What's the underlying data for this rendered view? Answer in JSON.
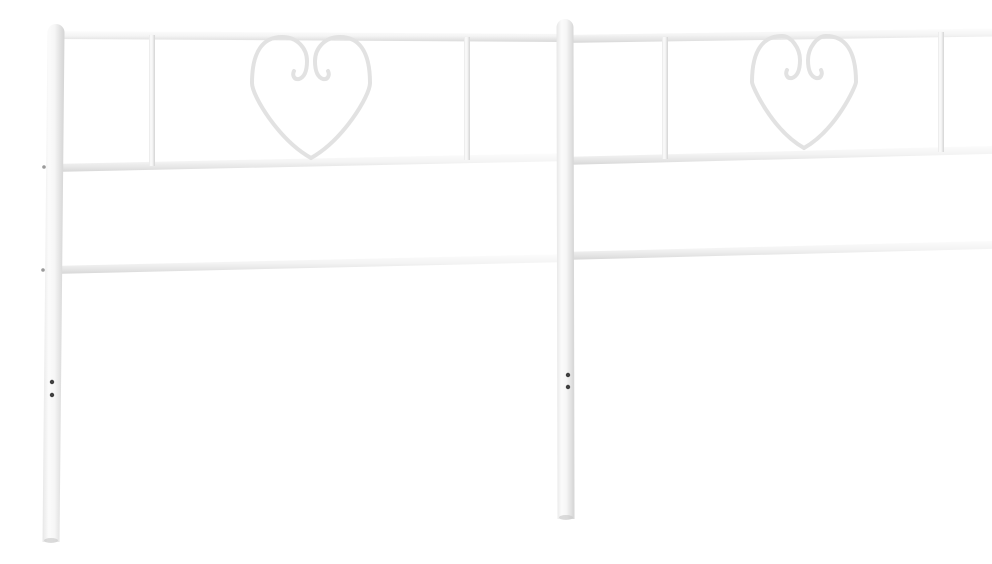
{
  "scene": {
    "description": "Product photo of a white metal headboard with two heart-shaped scrollwork panels, vertical balusters and three horizontal rails, on a plain white background",
    "background_color": "#ffffff",
    "colors": {
      "metal_highlight": "#fdfdfd",
      "metal_base": "#f4f4f4",
      "metal_shade": "#d6d6d6",
      "heart_stroke": "#e2e2e2",
      "bolt_dot": "#3f3f3f",
      "side_bolt": "#9a9a9a",
      "foot_shadow": "#c9c9c9"
    },
    "posts": [
      {
        "name": "left-post",
        "x_top": 16,
        "x_bottom": 11,
        "y_top": 8,
        "y_bottom": 526,
        "width": 17
      },
      {
        "name": "center-post",
        "x_top": 525,
        "x_bottom": 526,
        "y_top": 3,
        "y_bottom": 503,
        "width": 17
      },
      {
        "name": "right-post",
        "x_top": 982,
        "x_bottom": 984,
        "y_top": 3,
        "y_bottom": 469,
        "width": 16
      }
    ],
    "rails": [
      {
        "name": "top-rail-left-section",
        "x1": 13,
        "y1": 15,
        "x2": 530,
        "y2": 18,
        "thickness": 8
      },
      {
        "name": "top-rail-right-section",
        "x1": 521,
        "y1": 19,
        "x2": 986,
        "y2": 12,
        "thickness": 8
      },
      {
        "name": "middle-rail-left-section",
        "x1": 11,
        "y1": 148,
        "x2": 530,
        "y2": 137,
        "thickness": 8
      },
      {
        "name": "middle-rail-right-section",
        "x1": 521,
        "y1": 141,
        "x2": 986,
        "y2": 129,
        "thickness": 8
      },
      {
        "name": "bottom-rail-left-section",
        "x1": 11,
        "y1": 250,
        "x2": 530,
        "y2": 238,
        "thickness": 8
      },
      {
        "name": "bottom-rail-right-section",
        "x1": 521,
        "y1": 236,
        "x2": 986,
        "y2": 224,
        "thickness": 8
      }
    ],
    "balusters": [
      {
        "name": "left-section-baluster-1",
        "x": 112,
        "y_top": 19,
        "y_bottom": 150,
        "width": 6
      },
      {
        "name": "left-section-baluster-2",
        "x": 427,
        "y_top": 21,
        "y_bottom": 144,
        "width": 6
      },
      {
        "name": "right-section-baluster-1",
        "x": 625,
        "y_top": 21,
        "y_bottom": 143,
        "width": 6
      },
      {
        "name": "right-section-baluster-2",
        "x": 901,
        "y_top": 16,
        "y_bottom": 136,
        "width": 6
      }
    ],
    "hearts": [
      {
        "name": "left-heart-scroll",
        "cx": 271,
        "top": 21,
        "bottom": 142,
        "half_width": 59,
        "stroke_width": 4
      },
      {
        "name": "right-heart-scroll",
        "cx": 764,
        "top": 20,
        "bottom": 132,
        "half_width": 52,
        "stroke_width": 4
      }
    ],
    "bolts": [
      {
        "name": "left-post-bolt-upper",
        "x": 12,
        "y": 366,
        "r": 2.2
      },
      {
        "name": "left-post-bolt-lower",
        "x": 12,
        "y": 379,
        "r": 2.2
      },
      {
        "name": "center-post-bolt-upper",
        "x": 528,
        "y": 359,
        "r": 2.2
      },
      {
        "name": "center-post-bolt-lower",
        "x": 528,
        "y": 371,
        "r": 2.2
      },
      {
        "name": "right-post-bolt-upper",
        "x": 986,
        "y": 324,
        "r": 2.2
      },
      {
        "name": "right-post-bolt-lower",
        "x": 986,
        "y": 336,
        "r": 2.2
      }
    ],
    "side_bolts": [
      {
        "name": "left-post-rail-bolt-middle",
        "x": 4,
        "y": 151,
        "r": 1.8
      },
      {
        "name": "left-post-rail-bolt-bottom",
        "x": 3,
        "y": 254,
        "r": 1.8
      }
    ]
  }
}
